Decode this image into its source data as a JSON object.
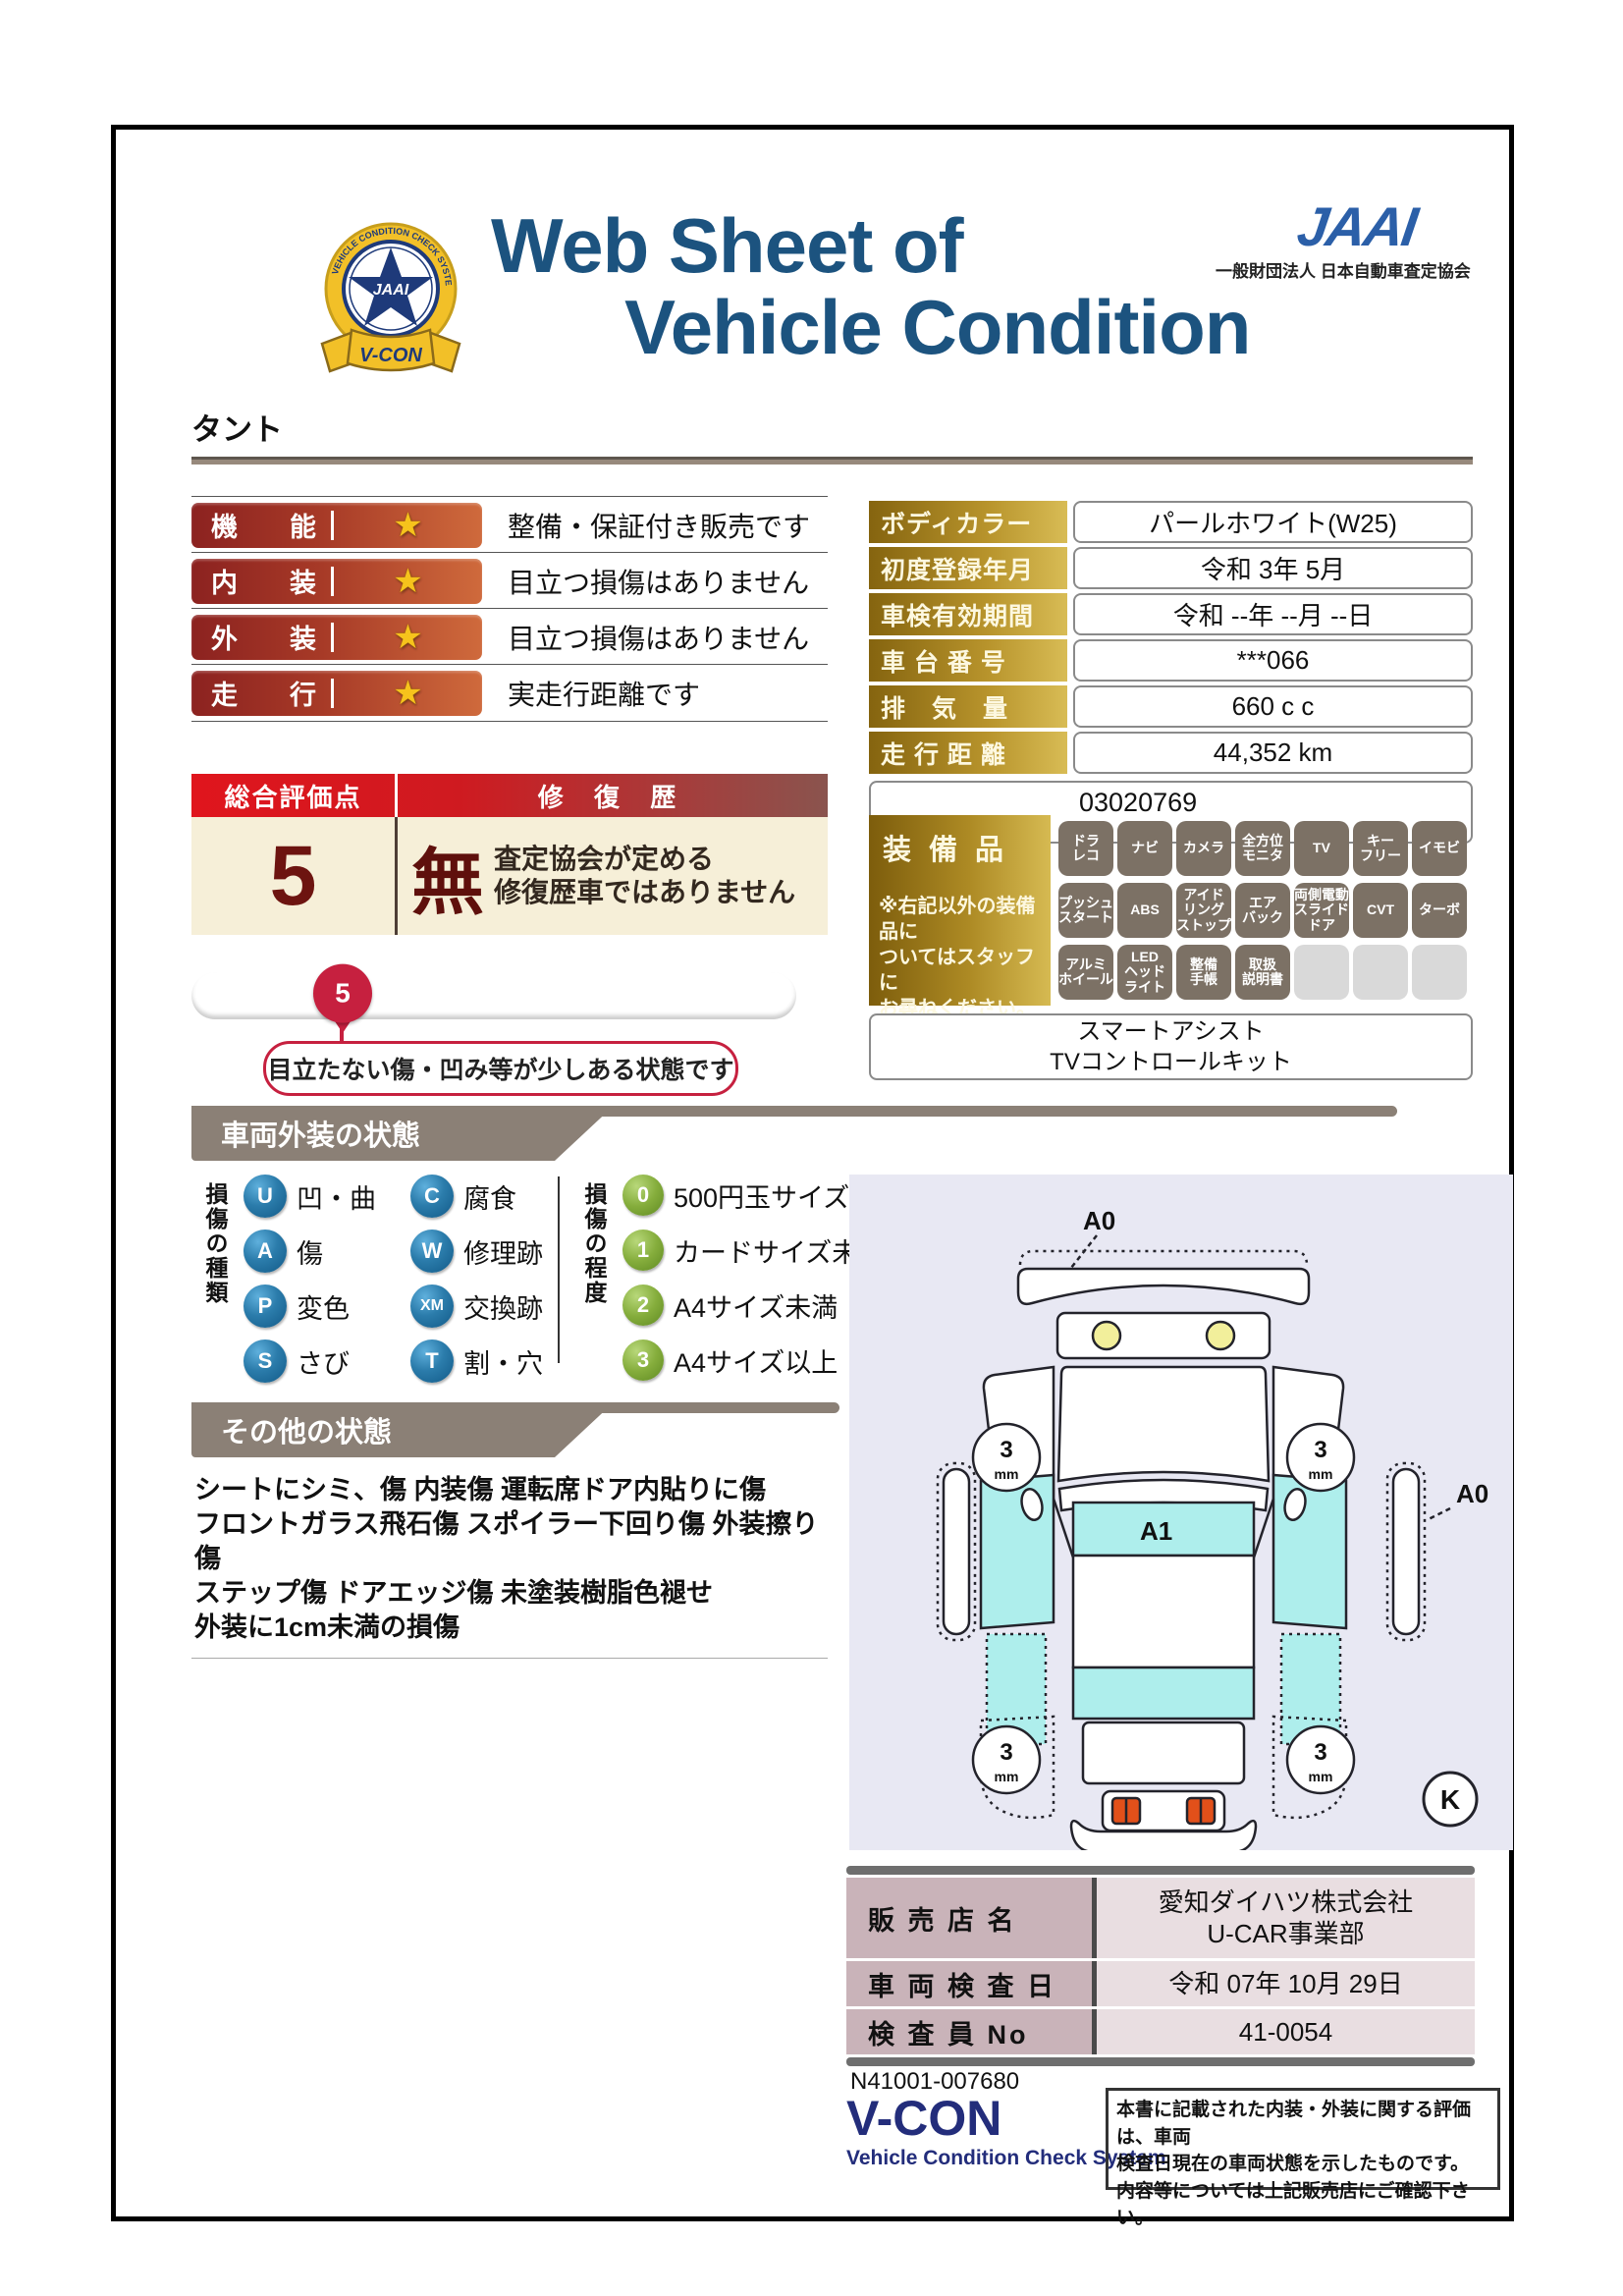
{
  "header": {
    "title_line1": "Web Sheet of",
    "title_line2": "Vehicle Condition",
    "jaai_logo": "JAAI",
    "jaai_subtitle": "一般財団法人 日本自動車査定協会",
    "badge": {
      "star_text": "JAAI",
      "ribbon": "V-CON",
      "ring_text": "VEHICLE CONDITION CHECK SYSTEM"
    }
  },
  "vehicle_name": "タント",
  "ratings": [
    {
      "label": "機　能",
      "star": "★",
      "desc": "整備・保証付き販売です"
    },
    {
      "label": "内　装",
      "star": "★",
      "desc": "目立つ損傷はありません"
    },
    {
      "label": "外　装",
      "star": "★",
      "desc": "目立つ損傷はありません"
    },
    {
      "label": "走　行",
      "star": "★",
      "desc": "実走行距離です"
    }
  ],
  "summary": {
    "score_header": "総合評価点",
    "repair_header": "修 復 歴",
    "score": "5",
    "repair_value": "無",
    "repair_note": "査定協会が定める\n修復歴車ではありません"
  },
  "scale": {
    "grades": [
      "S",
      "6",
      "5",
      "4.5",
      "4",
      "3.5",
      "3",
      "2",
      "1",
      "R"
    ],
    "selected": "5",
    "note": "目立たない傷・凹み等が少しある状態です"
  },
  "specs": {
    "rows": [
      {
        "label": "ボディカラー",
        "value": "パールホワイト(W25)"
      },
      {
        "label": "初度登録年月",
        "value": "令和 3年 5月"
      },
      {
        "label": "車検有効期間",
        "value": "令和 --年 --月 --日"
      },
      {
        "label": "車 台 番 号",
        "value": "***066"
      },
      {
        "label": "排　気　量",
        "value": "660 c c"
      },
      {
        "label": "走 行 距 離",
        "value": "44,352 km"
      }
    ],
    "inspection_no": "03020769"
  },
  "equipment": {
    "header": "装備品",
    "note": "※右記以外の装備品に\nついてはスタッフに\nお尋ねください。",
    "badges": [
      {
        "text": "ドラ\nレコ"
      },
      {
        "text": "ナビ"
      },
      {
        "text": "カメラ"
      },
      {
        "text": "全方位\nモニタ"
      },
      {
        "text": "TV"
      },
      {
        "text": "キー\nフリー"
      },
      {
        "text": "イモビ"
      },
      {
        "text": "プッシュ\nスタート"
      },
      {
        "text": "ABS"
      },
      {
        "text": "アイド\nリング\nストップ"
      },
      {
        "text": "エア\nバック"
      },
      {
        "text": "両側電動\nスライド\nドア"
      },
      {
        "text": "CVT"
      },
      {
        "text": "ターボ"
      },
      {
        "text": "アルミ\nホイール"
      },
      {
        "text": "LED\nヘッド\nライト"
      },
      {
        "text": "整備\n手帳"
      },
      {
        "text": "取扱\n説明書"
      },
      {
        "text": ""
      },
      {
        "text": ""
      },
      {
        "text": ""
      }
    ],
    "extra_lines": "スマートアシスト\nTVコントロールキット"
  },
  "exterior": {
    "header": "車両外装の状態",
    "type_label": "損傷の種類",
    "types": [
      {
        "code": "U",
        "label": "凹・曲"
      },
      {
        "code": "A",
        "label": "傷"
      },
      {
        "code": "P",
        "label": "変色"
      },
      {
        "code": "S",
        "label": "さび"
      },
      {
        "code": "C",
        "label": "腐食"
      },
      {
        "code": "W",
        "label": "修理跡"
      },
      {
        "code": "XM",
        "label": "交換跡"
      },
      {
        "code": "T",
        "label": "割・穴"
      }
    ],
    "degree_label": "損傷の程度",
    "degrees": [
      {
        "code": "0",
        "label": "500円玉サイズ未満"
      },
      {
        "code": "1",
        "label": "カードサイズ未満"
      },
      {
        "code": "2",
        "label": "A4サイズ未満"
      },
      {
        "code": "3",
        "label": "A4サイズ以上"
      }
    ]
  },
  "other": {
    "header": "その他の状態",
    "text": "シートにシミ、傷 内装傷 運転席ドア内貼りに傷\nフロントガラス飛石傷 スポイラー下回り傷 外装擦り傷\nステップ傷 ドアエッジ傷 未塗装樹脂色褪せ\n外装に1cm未満の損傷"
  },
  "diagram": {
    "front_label": "A0",
    "side_label": "A0",
    "roof_label": "A1",
    "wheel_value": "3",
    "wheel_unit": "mm",
    "key_label": "K"
  },
  "dealer": {
    "rows": [
      {
        "label": "販 売 店 名",
        "value": "愛知ダイハツ株式会社\nU-CAR事業部"
      },
      {
        "label": "車 両 検 査 日",
        "value": "令和 07年 10月 29日"
      },
      {
        "label": "検 査 員 No",
        "value": "41-0054"
      }
    ]
  },
  "footer": {
    "doc_no": "N41001-007680",
    "vcon": "V-CON",
    "vcon_sub": "Vehicle Condition Check System",
    "disclaimer": "本書に記載された内装・外装に関する評価は、車両\n検査日現在の車両状態を示したものです。\n内容等については上記販売店にご確認下さい。"
  },
  "colors": {
    "navy_title": "#1c537f",
    "jaai_blue": "#2b5fa8",
    "rating_bar_dark": "#8c2220",
    "rating_bar_light": "#cf6a3c",
    "gold_dark": "#85640f",
    "gold_light": "#d8bc55",
    "summary_red": "#e0151d",
    "cream": "#f6efd8",
    "crimson": "#c6203f",
    "taupe_banner": "#8b8076",
    "type_badge_blue": "#2b7cab",
    "degree_badge_green": "#85ad3c",
    "diagram_bg": "#e8e8f3",
    "panel_cyan": "#aeeeec",
    "dealer_label_bg": "#c9b3b9",
    "dealer_value_bg": "#e9dee1",
    "vcon_navy": "#232d7b"
  }
}
